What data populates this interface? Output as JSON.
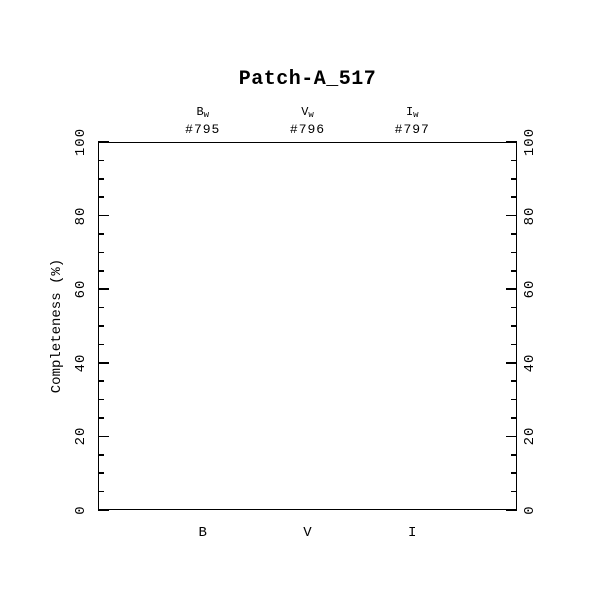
{
  "page": {
    "background_color": "#ffffff",
    "foreground_color": "#000000"
  },
  "chart_data": {
    "type": "scatter",
    "title": "Patch-A_517",
    "ylabel": "Completeness (%)",
    "ylim": [
      0,
      100
    ],
    "y_major_ticks": [
      0,
      20,
      40,
      60,
      80,
      100
    ],
    "y_minor_tick_step": 5,
    "x_categories": [
      "B",
      "V",
      "I"
    ],
    "x_positions": [
      0.25,
      0.5,
      0.75
    ],
    "top_annotations": [
      {
        "filter_base": "B",
        "filter_subscript": "w",
        "frame_id": "#795"
      },
      {
        "filter_base": "V",
        "filter_subscript": "w",
        "frame_id": "#796"
      },
      {
        "filter_base": "I",
        "filter_subscript": "w",
        "frame_id": "#797"
      }
    ],
    "series": [],
    "grid": false,
    "legend_position": "none"
  }
}
